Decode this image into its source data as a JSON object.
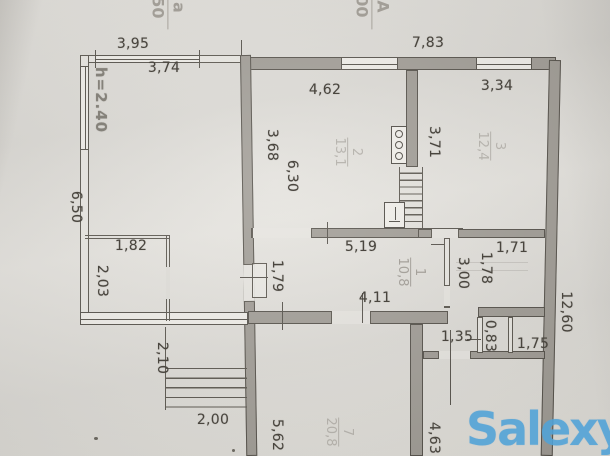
{
  "document_kind": "floor plan photo",
  "colors": {
    "paper": "#e0ded9",
    "ink": "#56524b",
    "wall_fill": "#a19d96",
    "stamp_gray": "#a29e97",
    "faint_pencil": "#7a756d",
    "watermark_blue": "#50a2d7"
  },
  "stamps": {
    "left": {
      "numerator": "а",
      "denominator": "50"
    },
    "right": {
      "numerator": "А",
      "denominator": "00"
    }
  },
  "dims": {
    "top_outer_width": "3,95",
    "top_inner_width": "3,74",
    "top_right_width": "7,83",
    "kitchen_width": "4,62",
    "bedroom_width": "3,34",
    "kitchen_height_left": "3,68",
    "kitchen_height_right": "3,71",
    "ceiling_height": "h=2.40",
    "left_side_height": "6,50",
    "living_height": "6,30",
    "closet_width": "1,82",
    "closet_height": "2,03",
    "hall_width": "5,19",
    "nook_width": "1,71",
    "nook_height": "1,78",
    "nook_depth": "3,00",
    "door_offset": "1,79",
    "lower_hall_width": "4,11",
    "steps_height": "2,10",
    "steps_width": "2,00",
    "corridor_height": "5,62",
    "bath_width": "1,35",
    "wc_width": "0,83",
    "bath_right_width": "1,75",
    "right_side_height": "12,60",
    "bottom_room_height": "4,63"
  },
  "rooms": {
    "room1": {
      "number": "1",
      "area": "10,8"
    },
    "room2": {
      "number": "2",
      "area": "13,1"
    },
    "room3": {
      "number": "3",
      "area": "12,4"
    },
    "room7": {
      "number": "7",
      "area": "20,8"
    }
  },
  "icons": {
    "stove": "stove-burners-icon",
    "sink": "sink-icon",
    "stairs": "staircase-icon",
    "steps": "entrance-steps-icon"
  },
  "watermark": {
    "text": "Salexy"
  }
}
